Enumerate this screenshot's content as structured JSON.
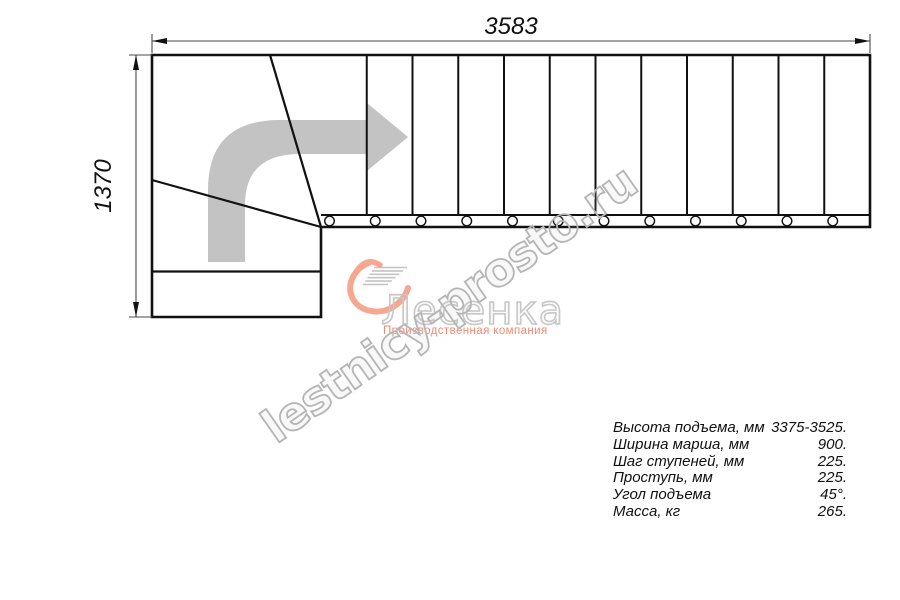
{
  "colors": {
    "ink": "#111111",
    "dim_line": "#4a4a4a",
    "arrow_gray": "#c3c3c3",
    "salmon": "#f5a78f",
    "salmon_text": "#ee8a73",
    "speedline_gray": "#c4c4c4",
    "watermark_gray": "#b5b5b5",
    "logo_gray": "#c7c7c7"
  },
  "dimensions": {
    "width_label": "3583",
    "height_label": "1370"
  },
  "plan": {
    "description": "L-shaped stair plan, top view, flight turning right",
    "step_line_count": 11,
    "tread_circle_count": 12,
    "direction_arrow_icon": "turn-right-arrow-icon"
  },
  "watermark": {
    "text": "lestnicy-prosto.ru"
  },
  "logo": {
    "icon": "heart-swoosh-icon",
    "name": "Лесенка",
    "tagline": "Производственная компания"
  },
  "specs": {
    "rows": [
      {
        "label": "Высота подъема, мм",
        "value": "3375-3525."
      },
      {
        "label": "Ширина марша, мм",
        "value": "900."
      },
      {
        "label": "Шаг ступеней, мм",
        "value": "225."
      },
      {
        "label": "Проступь, мм",
        "value": "225."
      },
      {
        "label": "Угол подъема",
        "value": "45°."
      },
      {
        "label": "Масса, кг",
        "value": "265."
      }
    ]
  }
}
